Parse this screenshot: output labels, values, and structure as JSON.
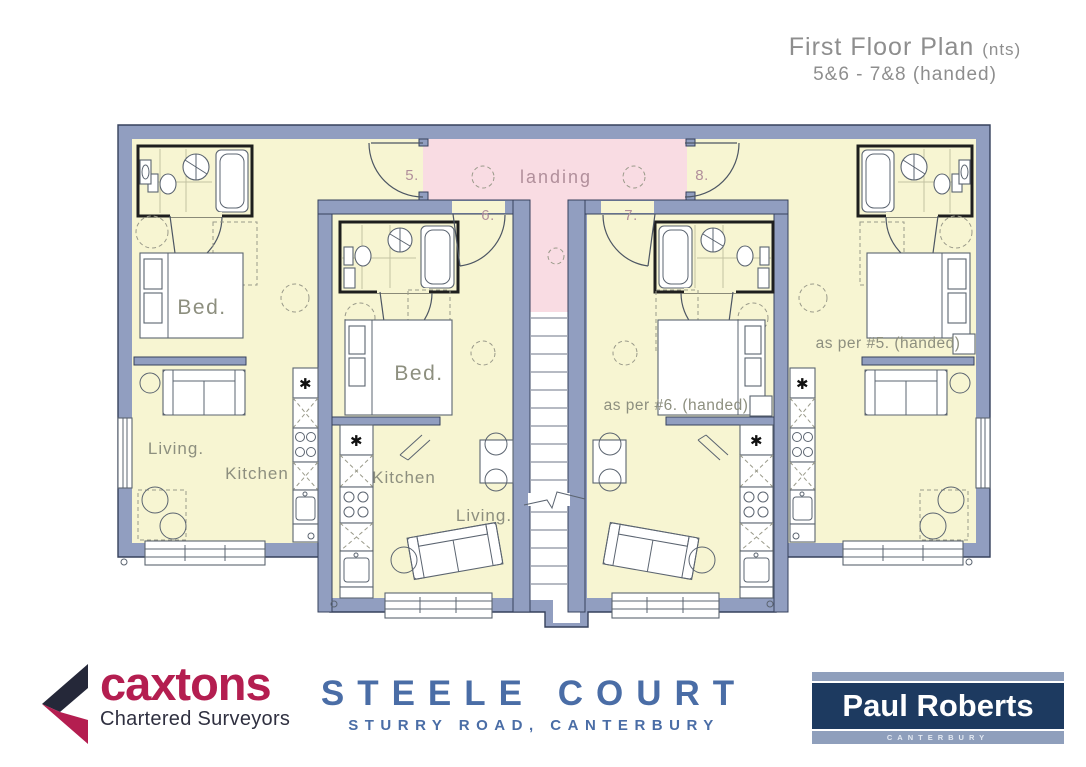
{
  "title": {
    "line1": "First Floor Plan",
    "nts": "(nts)",
    "line2": "5&6  -  7&8  (handed)"
  },
  "plan": {
    "landing_label": "landing",
    "symbols": {
      "appliance": "✱"
    },
    "unit5": {
      "number": "5.",
      "bed": "Bed.",
      "living": "Living.",
      "kitchen": "Kitchen"
    },
    "unit6": {
      "number": "6.",
      "bed": "Bed.",
      "living": "Living.",
      "kitchen": "Kitchen"
    },
    "unit7": {
      "number": "7.",
      "note": "as per #6. (handed)"
    },
    "unit8": {
      "number": "8.",
      "note": "as per #5. (handed)"
    }
  },
  "footer": {
    "caxtons": {
      "name": "caxtons",
      "tagline": "Chartered Surveyors"
    },
    "project": {
      "name": "STEELE COURT",
      "address": "STURRY ROAD, CANTERBURY"
    },
    "agent": {
      "name": "Paul Roberts",
      "location": "CANTERBURY"
    }
  },
  "colors": {
    "wall": "#919ec0",
    "wall_outline": "#36415c",
    "room": "#f7f5d2",
    "landing": "#f9dce3",
    "label_gray": "#8d8f7f",
    "label_mauve": "#b18f9b",
    "title_gray": "#8e8e8e",
    "steele_blue": "#4a6da6",
    "caxtons_red": "#b41e50",
    "caxtons_dark": "#252839",
    "roberts_navy": "#1d3a60",
    "roberts_light": "#8f9fbc"
  }
}
